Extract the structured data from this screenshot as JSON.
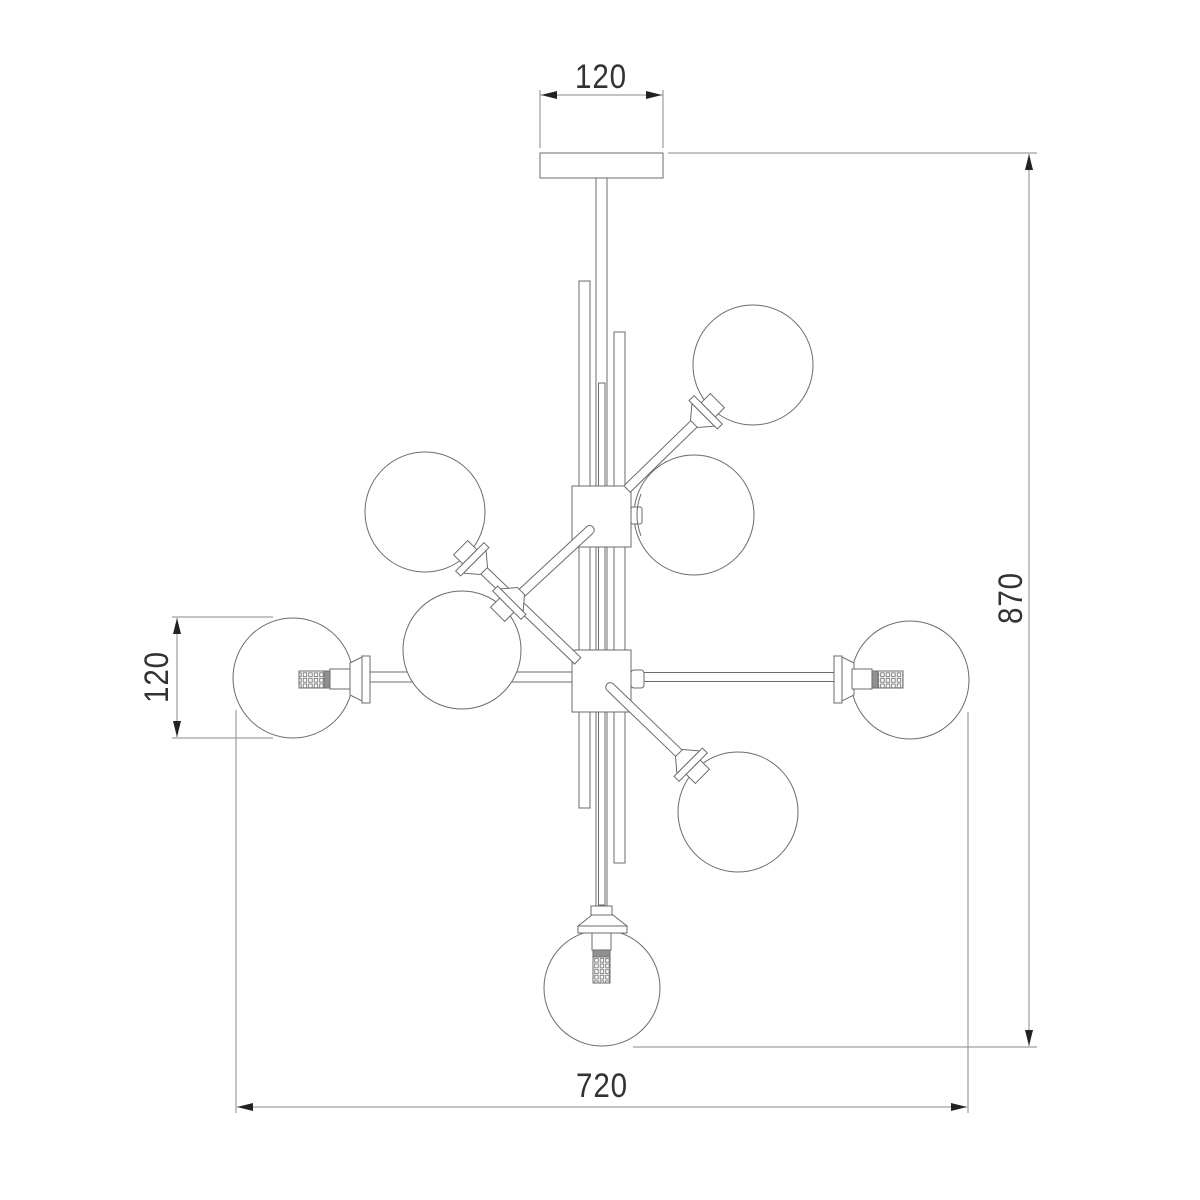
{
  "drawing": {
    "subject": "Ceiling chandelier technical line drawing, front elevation: central stem with ceiling mount plate, two square junction hubs, staggered decorative rods and 8 glass globe shades",
    "background": "#ffffff",
    "line_color": "#6b6b6b",
    "dim_line_color": "#8a8a8a",
    "arrow_color": "#222222",
    "text_color": "#333333",
    "globe_count": 8,
    "dimensions": {
      "mount_width": "120",
      "overall_height": "870",
      "globe_diameter": "120",
      "overall_width": "720"
    }
  }
}
